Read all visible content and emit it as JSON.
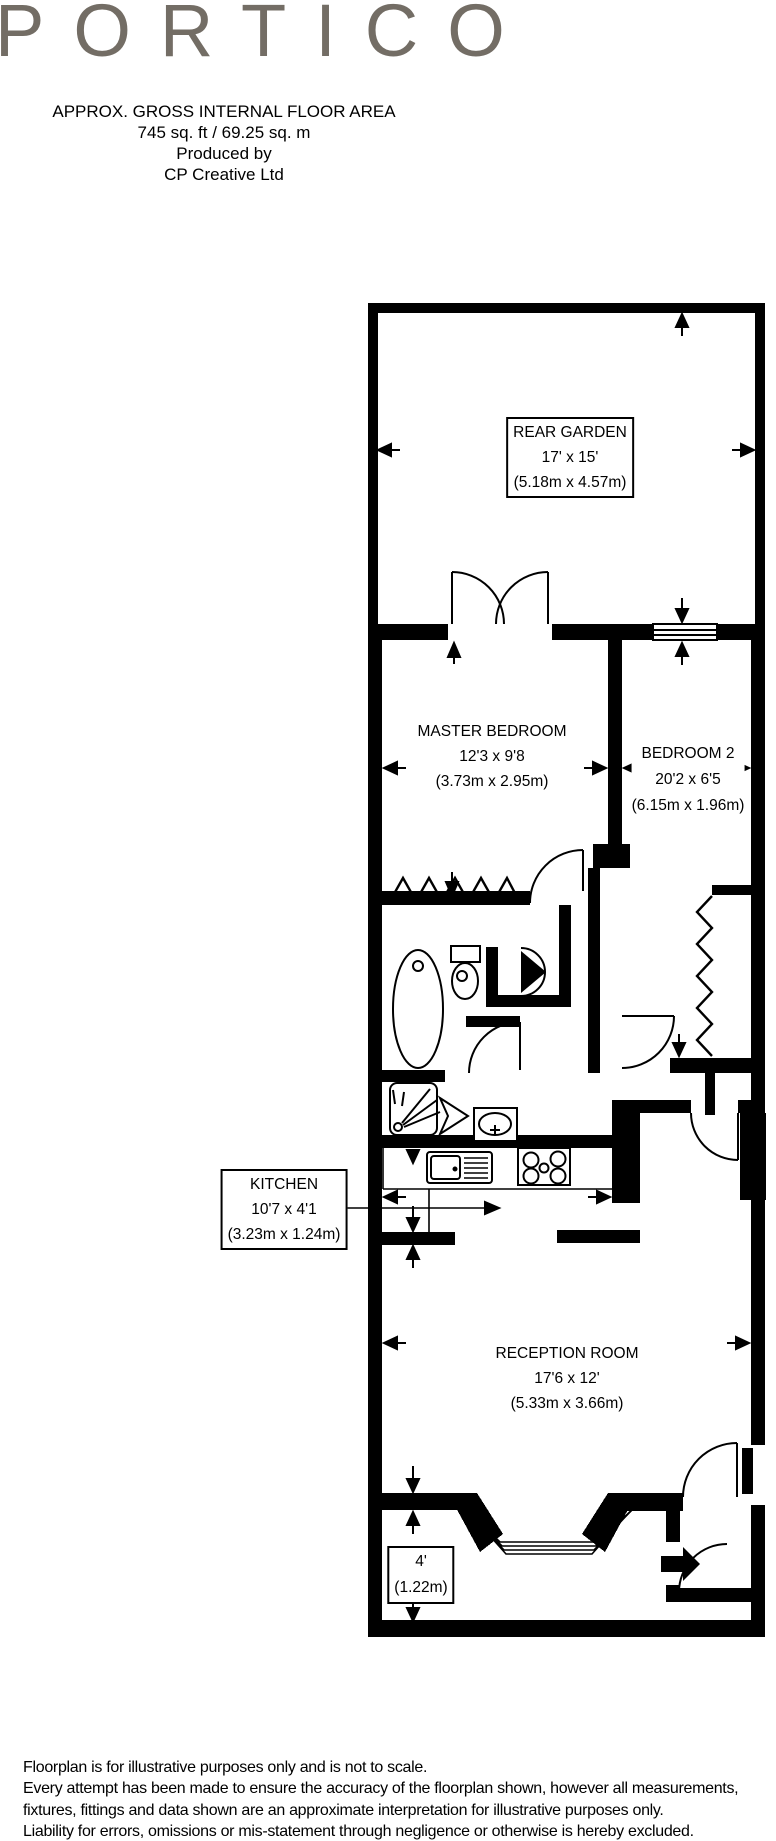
{
  "logo": {
    "text": "PORTICO",
    "color": "#736d65"
  },
  "header": {
    "line1": "APPROX. GROSS INTERNAL FLOOR AREA",
    "line2": "745 sq. ft / 69.25 sq. m",
    "line3": "Produced by",
    "line4": "CP Creative Ltd"
  },
  "rooms": {
    "rear_garden": {
      "name": "REAR GARDEN",
      "imperial": "17' x 15'",
      "metric": "(5.18m x 4.57m)"
    },
    "master_bedroom": {
      "name": "MASTER BEDROOM",
      "imperial": "12'3 x 9'8",
      "metric": "(3.73m x 2.95m)"
    },
    "bedroom2": {
      "name": "BEDROOM 2",
      "imperial": "20'2 x 6'5",
      "metric": "(6.15m x 1.96m)"
    },
    "kitchen": {
      "name": "KITCHEN",
      "imperial": "10'7 x 4'1",
      "metric": "(3.23m x 1.24m)"
    },
    "reception": {
      "name": "RECEPTION ROOM",
      "imperial": "17'6 x 12'",
      "metric": "(5.33m x 3.66m)"
    },
    "bay": {
      "imperial": "4'",
      "metric": "(1.22m)"
    }
  },
  "footer": {
    "line1": "Floorplan is for illustrative purposes only and is not to scale.",
    "line2": "Every attempt has been made to ensure the accuracy of the floorplan shown, however all measurements,",
    "line3": "fixtures, fittings and data shown are an approximate interpretation for illustrative purposes only.",
    "line4": "Liability for errors, omissions or mis-statement through negligence or otherwise is hereby excluded."
  },
  "colors": {
    "walls": "#000000",
    "logo": "#736d65",
    "background": "#ffffff"
  }
}
